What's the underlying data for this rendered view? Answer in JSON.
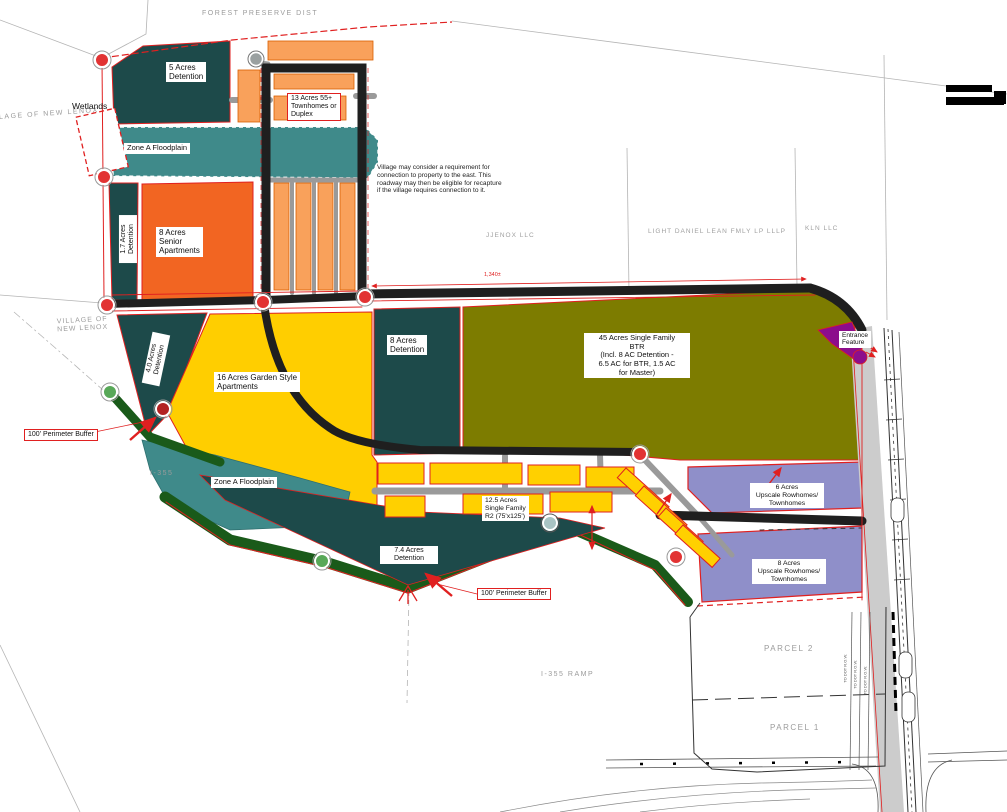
{
  "plan": {
    "type": "land-use-site-plan",
    "labels": {
      "forest_preserve": "FOREST PRESERVE DIST",
      "village_topleft": "VILLAGE OF NEW LENOX",
      "wetlands": "Wetlands",
      "five_acres": "5 Acres\nDetention",
      "thirteen_acres": "13 Acres 55+\nTownhomes or\nDuplex",
      "zone_a_floodplain_1": "Zone A Floodplain",
      "one_seven_detention": "1.7 Acres\nDetention",
      "eight_senior": "8 Acres\nSenior\nApartments",
      "village_note": "Village may consider a requirement for\nconnection to property to the east. This\nroadway may then be eligible for recapture\nif the village requires connection to it.",
      "jjenox": "JJENOX LLC",
      "light_daniel": "LIGHT DANIEL LEAN FMLY LP LLLP",
      "kln": "KLN LLC",
      "village_left": "VILLAGE OF\nNEW LENOX",
      "four_zero_detention": "4.0 Acres\nDetention",
      "sixteen_garden": "16 Acres Garden Style\nApartments",
      "eight_detention": "8 Acres\nDetention",
      "fortyfive_btr": "45 Acres Single Family\nBTR\n(Incl. 8 AC Detention -\n6.5 AC for BTR, 1.5 AC\nfor Master)",
      "entrance_feature": "Entrance\nFeature",
      "perimeter_buffer_1": "100' Perimeter Buffer",
      "i355": "I-355",
      "zone_a_floodplain_2": "Zone A Floodplain",
      "twelve_five": "12.5 Acres\nSingle Family\nR2 (75'x125')",
      "seven_four_detention": "7.4 Acres\nDetention",
      "perimeter_buffer_2": "100' Perimeter Buffer",
      "six_upscale": "6 Acres\nUpscale Rowhomes/\nTownhomes",
      "eight_upscale": "8 Acres\nUpscale Rowhomes/\nTownhomes",
      "parcel_2": "PARCEL 2",
      "parcel_1": "PARCEL 1",
      "i355_ramp": "I-355 RAMP",
      "dim_1340": "1,340±",
      "dim_row": "TO DOT R.O.W."
    },
    "colors": {
      "detention_teal": "#1d4a4a",
      "floodplain_teal": "#3f8a8a",
      "senior_orange": "#f26522",
      "townhome_orange": "#f9a15b",
      "garden_yellow": "#ffce00",
      "btr_olive": "#7d7c00",
      "rowhome_purple": "#8f8fc9",
      "entrance_purple": "#8c0d8c",
      "buffer_green": "#1a5a1a",
      "road_black": "#1f1f1f",
      "road_gray": "#9a9a9a",
      "highway_gray": "#cccccc",
      "outline_red": "#e02020",
      "map_text_gray": "#9b9b9b"
    }
  }
}
